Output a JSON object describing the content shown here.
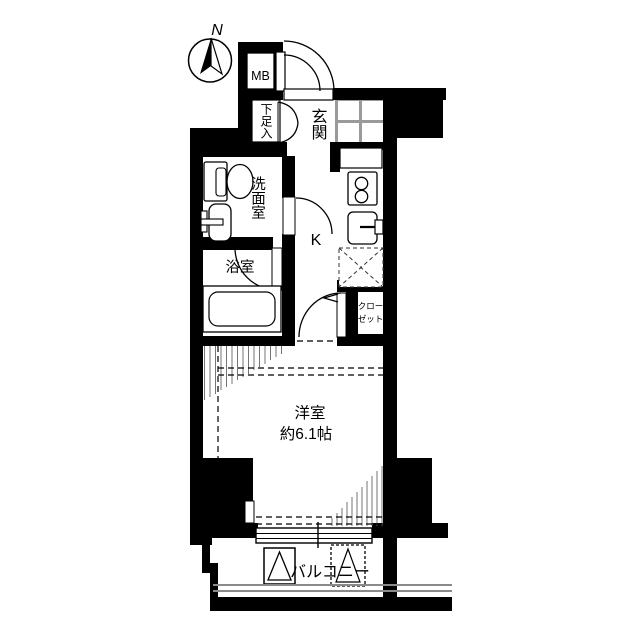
{
  "compass": {
    "north_label": "N"
  },
  "labels": {
    "meter_box": "MB",
    "shoe_cabinet": "下足入",
    "entrance": "玄関",
    "washroom": "洗面室",
    "bathroom": "浴室",
    "kitchen": "K",
    "closet_line1": "クロー",
    "closet_line2": "ゼット",
    "room_name": "洋室",
    "room_size": "約6.1帖",
    "balcony": "バルコニー"
  },
  "colors": {
    "wall": "#000000",
    "background": "#ffffff",
    "tile_grout": "#9a9a9a",
    "hatch_line": "#666666",
    "railing": "#8a8a8a"
  }
}
